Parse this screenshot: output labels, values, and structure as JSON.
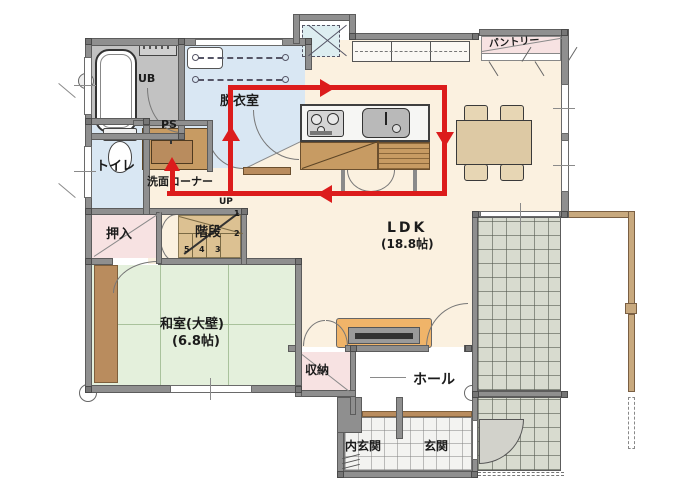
{
  "colors": {
    "accent_red": "#dc1c1c",
    "wall": "#8f8f8f",
    "floor_cream": "#fbf1e0",
    "floor_blue": "#d9e7f3",
    "floor_green": "#e4f0dc",
    "floor_pink": "#f7e2e2",
    "floor_gray": "#c2c2c2",
    "wood": "#c79b63",
    "wood_dark": "#b98c5e",
    "stair": "#dcc192",
    "deck": "#d8dbcf",
    "tile": "#f3f3f1",
    "tv_board": "#f0b469",
    "table": "#ddc9a4",
    "pergola": "#c8a97e"
  },
  "labels": {
    "ub": "UB",
    "datsui": "脱衣室",
    "ps": "PS",
    "toilet": "トイレ",
    "senmen": "洗面コーナー",
    "oshiire": "押入",
    "kaidan": "階段",
    "up": "UP",
    "stairs": [
      "1",
      "2",
      "3",
      "4",
      "5"
    ],
    "ldk": "LDK",
    "ldk_size": "(18.8帖)",
    "pantry": "パントリー",
    "washitsu": "和室(大壁)",
    "washitsu_size": "(6.8帖)",
    "shuno": "収納",
    "hall": "ホール",
    "uchigenkan": "内玄関",
    "genkan": "玄関"
  }
}
